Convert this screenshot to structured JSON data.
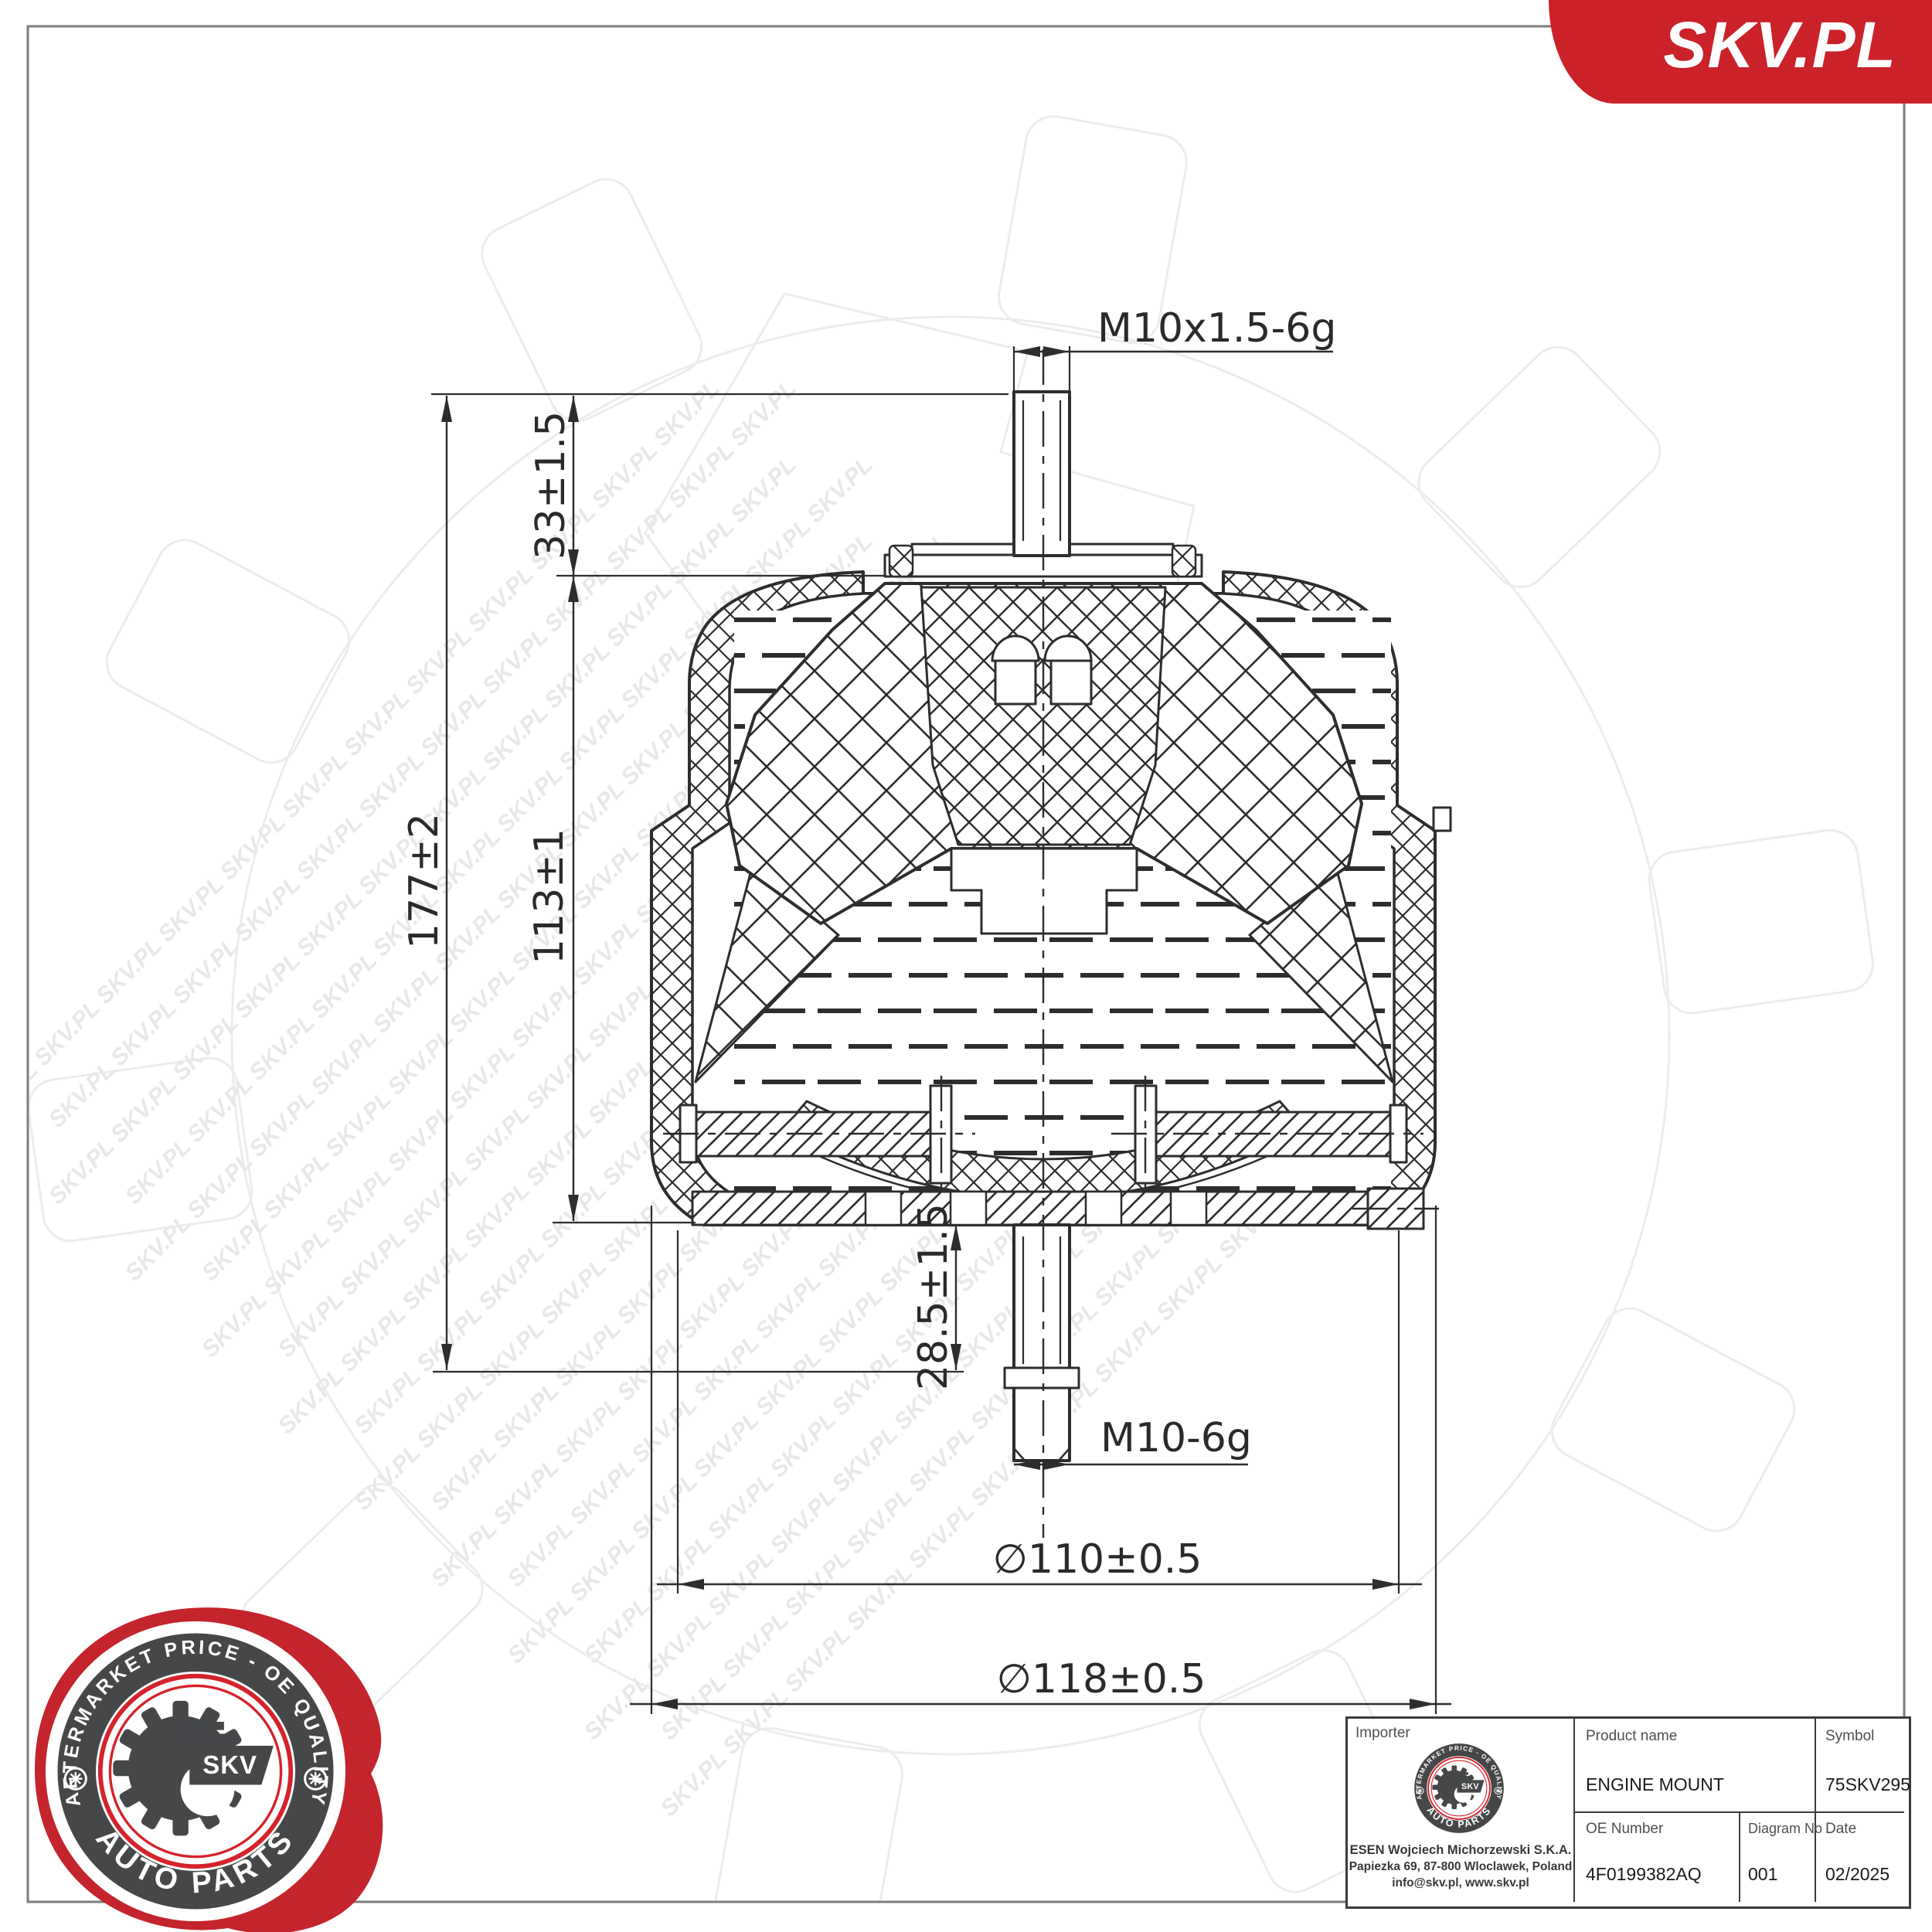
{
  "brand": {
    "banner_text": "SKV.PL",
    "banner_color": "#cb2129"
  },
  "watermark": {
    "row": "SKV.PL SKV.PL SKV.PL SKV.PL SKV.PL SKV.PL SKV.PL SKV.PL SKV.PL SKV.PL SKV.PL SKV.PL"
  },
  "badge": {
    "top_text": "AFTERMARKET PRICE - OE QUALITY",
    "bottom_text": "AUTO PARTS",
    "center_text": "SKV"
  },
  "drawing": {
    "labels": {
      "thread_top": "M10x1.5-6g",
      "thread_bottom": "M10-6g",
      "dim_total_height": "177±2",
      "dim_upper": "33±1.5",
      "dim_body": "113±1",
      "dim_lower_stud": "28.5±1.5",
      "dia_inner": "∅110±0.5",
      "dia_outer": "∅118±0.5"
    }
  },
  "table": {
    "importer": {
      "label": "Importer",
      "company": "ESEN Wojciech Michorzewski S.K.A.",
      "address": "Papiezka 69, 87-800 Wloclawek, Poland",
      "contact": "info@skv.pl, www.skv.pl"
    },
    "product": {
      "label": "Product name",
      "value": "ENGINE MOUNT"
    },
    "symbol": {
      "label": "Symbol",
      "value": "75SKV295"
    },
    "oe": {
      "label": "OE Number",
      "value": "4F0199382AQ"
    },
    "diagram": {
      "label": "Diagram No",
      "value": "001"
    },
    "date": {
      "label": "Date",
      "value": "02/2025"
    }
  }
}
